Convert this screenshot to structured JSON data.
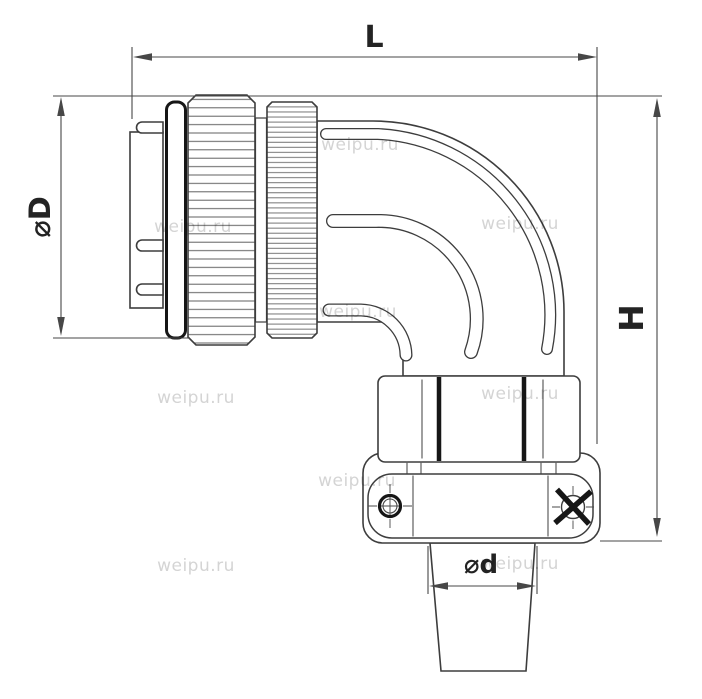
{
  "labels": {
    "length": "L",
    "outer_diameter": "⌀D",
    "height": "H",
    "cable_diameter": "⌀d"
  },
  "watermark": {
    "text": "weipu.ru"
  },
  "colors": {
    "background": "#ffffff",
    "line": "#3d3d3d",
    "lineThin": "#5f5f5f",
    "black": "#161616",
    "dim": "#474747",
    "wm": "#d4d4d4"
  }
}
